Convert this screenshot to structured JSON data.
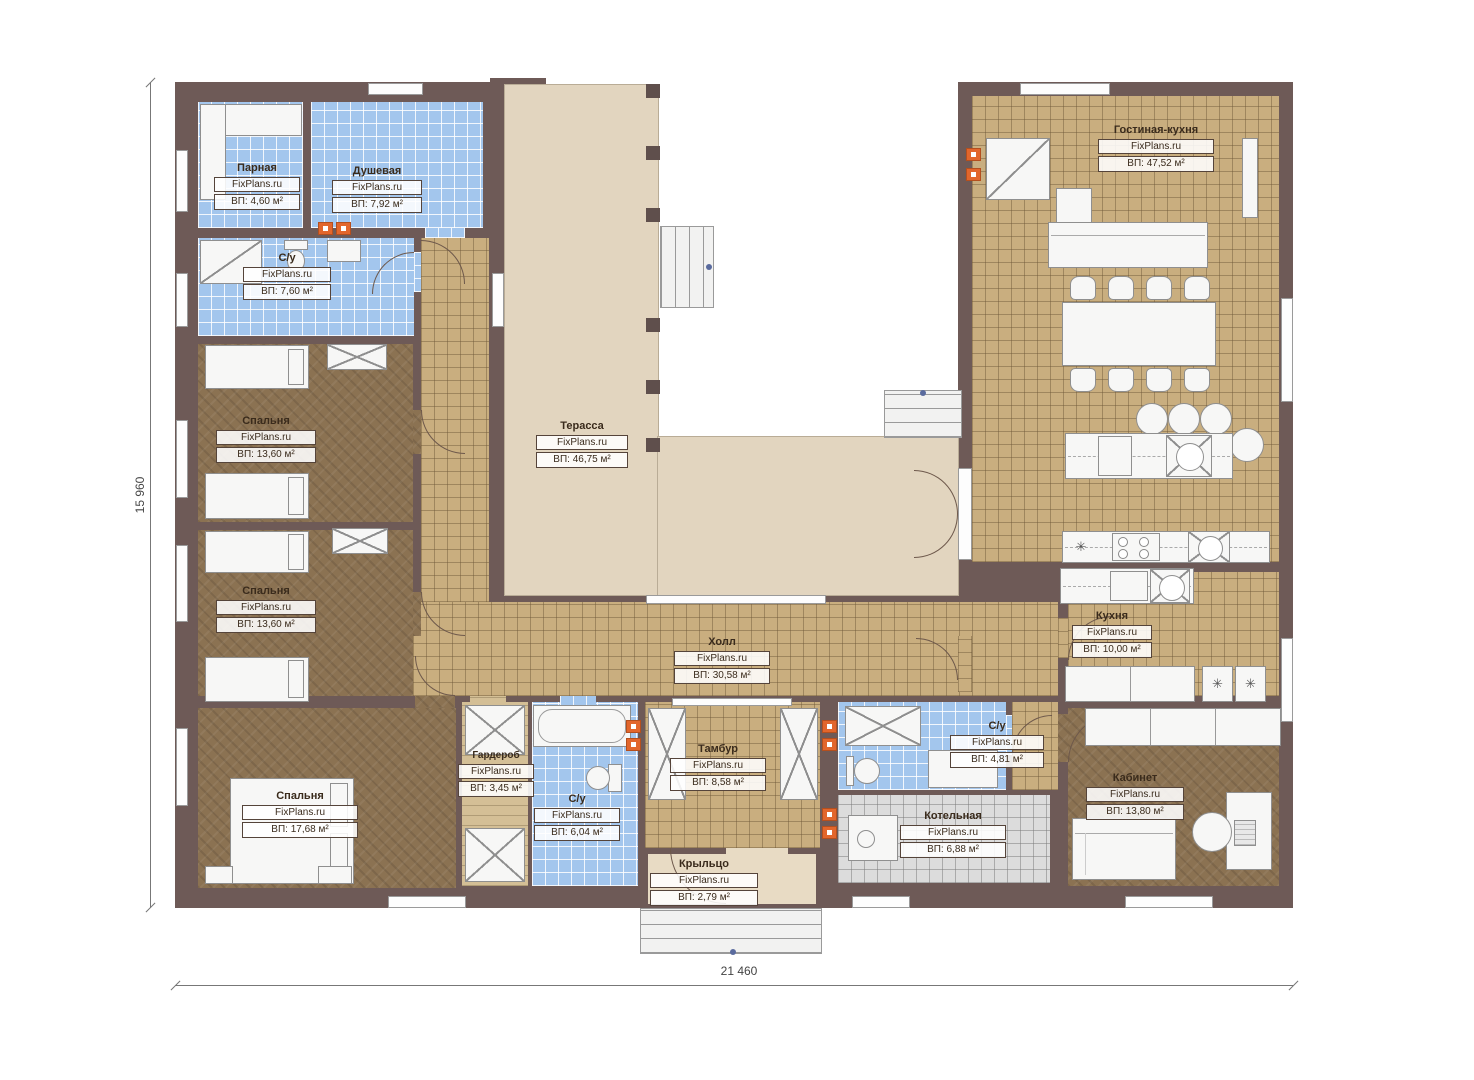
{
  "brand": {
    "watermark": "FixPlans.ru"
  },
  "dimensions": {
    "left": "15 960",
    "bottom": "21 460"
  },
  "rooms": [
    {
      "name": "Парная",
      "area": "ВП: 4,60 м²"
    },
    {
      "name": "Душевая",
      "area": "ВП: 7,92 м²"
    },
    {
      "name": "С/у",
      "area": "ВП: 7,60 м²"
    },
    {
      "name": "Спальня",
      "area": "ВП: 13,60 м²"
    },
    {
      "name": "Спальня",
      "area": "ВП: 13,60 м²"
    },
    {
      "name": "Спальня",
      "area": "ВП: 17,68 м²"
    },
    {
      "name": "Терасса",
      "area": "ВП: 46,75 м²"
    },
    {
      "name": "Холл",
      "area": "ВП: 30,58 м²"
    },
    {
      "name": "Гостиная-кухня",
      "area": "ВП: 47,52 м²"
    },
    {
      "name": "Кухня",
      "area": "ВП: 10,00 м²"
    },
    {
      "name": "Гардероб",
      "area": "ВП: 3,45 м²"
    },
    {
      "name": "С/у",
      "area": "ВП: 6,04 м²"
    },
    {
      "name": "Тамбур",
      "area": "ВП: 8,58 м²"
    },
    {
      "name": "С/у",
      "area": "ВП: 4,81 м²"
    },
    {
      "name": "Котельная",
      "area": "ВП: 6,88 м²"
    },
    {
      "name": "Кабинет",
      "area": "ВП: 13,80 м²"
    },
    {
      "name": "Крыльцо",
      "area": "ВП: 2,79 м²"
    }
  ],
  "symbols": {
    "appliance": "✳"
  },
  "colors": {
    "wall": "#6e5a57",
    "tile_tan": "#c9ae7f",
    "tile_blue": "#a3c6ed",
    "tile_gray": "#dcdcdc",
    "wood": "#8b7252",
    "terrace": "#e2d5bf",
    "accent_orange": "#e2662c"
  }
}
